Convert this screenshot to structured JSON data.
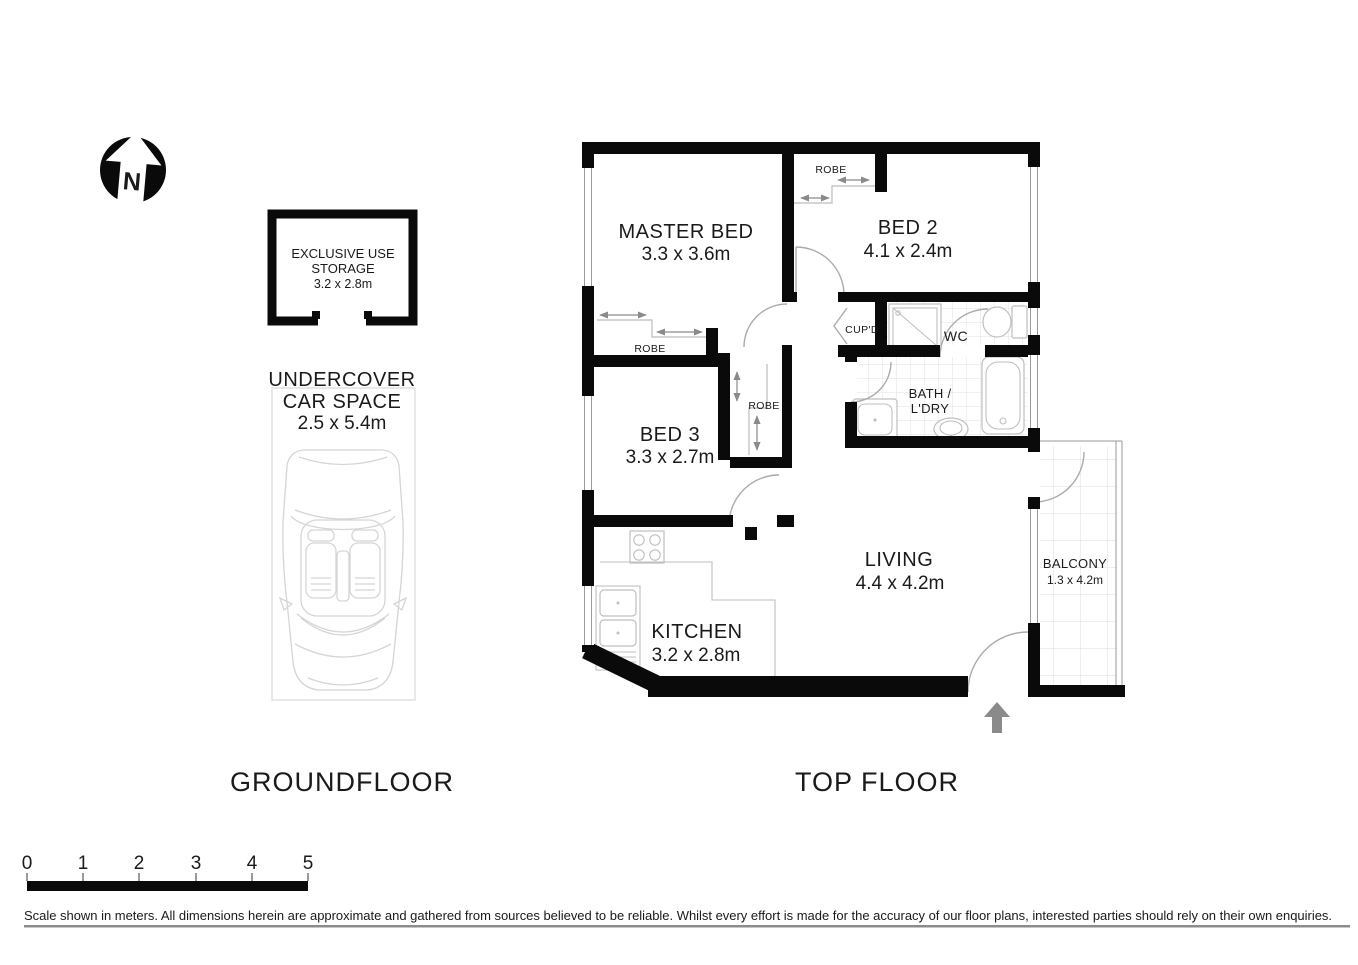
{
  "page": {
    "width": 1358,
    "height": 960,
    "background": "#ffffff"
  },
  "colors": {
    "wall": "#0a0a0a",
    "tile_line": "#e0e0e0",
    "fixture_line": "#bfbfbf",
    "door_arc": "#ababab",
    "arrow_gray": "#8a8a8a",
    "text": "#1a1a1a",
    "divider_line": "#8c8c8c"
  },
  "north_indicator": {
    "letter": "N"
  },
  "ground_floor": {
    "title": "GROUNDFLOOR",
    "storage": {
      "line1": "EXCLUSIVE USE",
      "line2": "STORAGE",
      "dims": "3.2 x 2.8m"
    },
    "car_space": {
      "line1": "UNDERCOVER",
      "line2": "CAR SPACE",
      "dims": "2.5 x 5.4m"
    }
  },
  "top_floor": {
    "title": "TOP FLOOR",
    "rooms": {
      "master_bed": {
        "name": "MASTER BED",
        "dims": "3.3 x 3.6m"
      },
      "bed2": {
        "name": "BED 2",
        "dims": "4.1 x 2.4m"
      },
      "bed3": {
        "name": "BED 3",
        "dims": "3.3 x 2.7m"
      },
      "living": {
        "name": "LIVING",
        "dims": "4.4 x 4.2m"
      },
      "kitchen": {
        "name": "KITCHEN",
        "dims": "3.2 x 2.8m"
      },
      "balcony": {
        "name": "BALCONY",
        "dims": "1.3 x 4.2m"
      },
      "bath": {
        "name_line1": "BATH /",
        "name_line2": "L'DRY"
      },
      "wc": {
        "name": "WC"
      },
      "cupboard": {
        "name": "CUP'D"
      },
      "robe_bed2": {
        "name": "ROBE"
      },
      "robe_master": {
        "name": "ROBE"
      },
      "robe_bed3": {
        "name": "ROBE"
      }
    }
  },
  "scale_bar": {
    "ticks": [
      "0",
      "1",
      "2",
      "3",
      "4",
      "5"
    ]
  },
  "disclaimer": "Scale shown in meters. All dimensions herein are approximate and gathered from sources believed to be  reliable. Whilst every effort is made for the accuracy of our floor plans, interested parties should rely on their own enquiries."
}
